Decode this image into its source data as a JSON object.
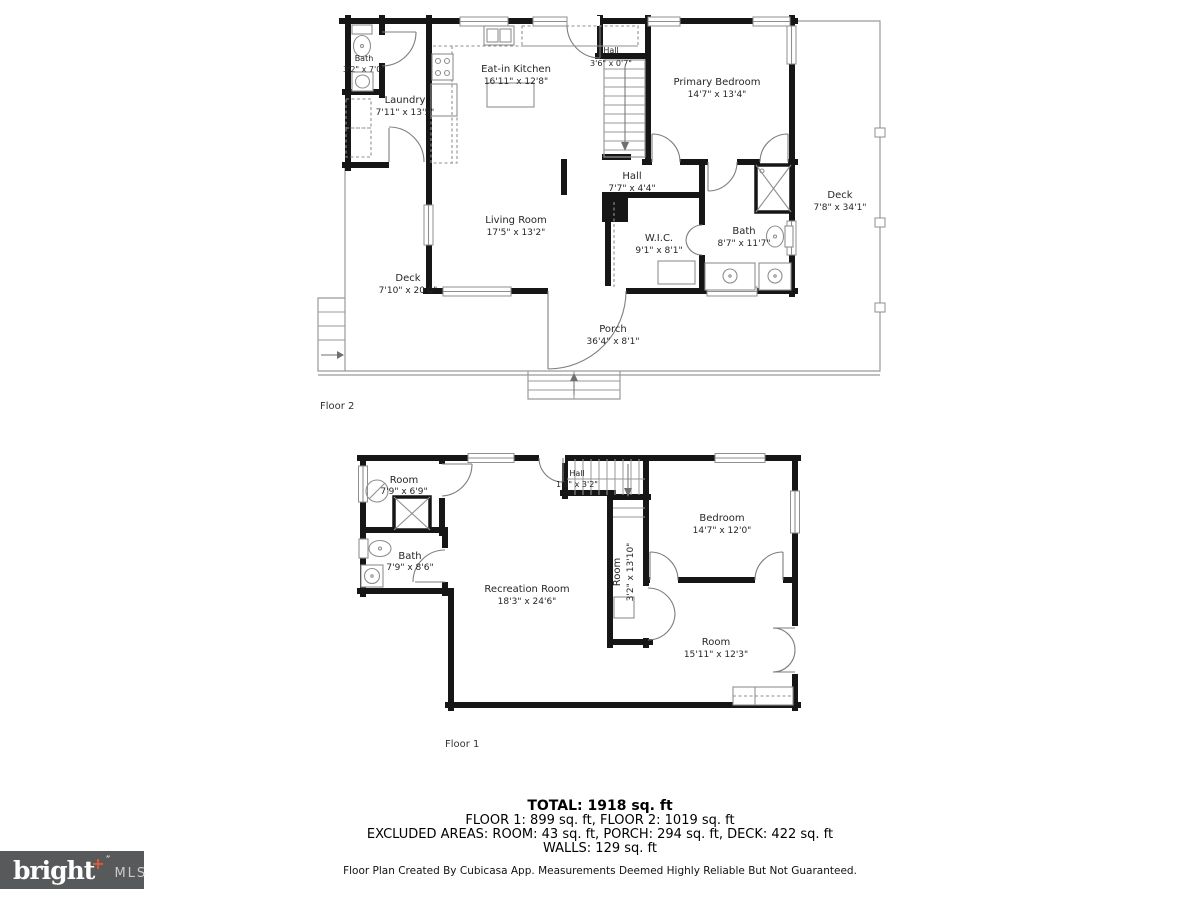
{
  "floor2": {
    "floor_label": "Floor 2",
    "rooms": {
      "bath_small": {
        "name": "Bath",
        "dims": "3'2\" x 7'0\""
      },
      "laundry": {
        "name": "Laundry",
        "dims": "7'11\" x 13'5\""
      },
      "kitchen": {
        "name": "Eat-in Kitchen",
        "dims": "16'11\" x 12'8\""
      },
      "hall_upper": {
        "name": "Hall",
        "dims": "3'6\" x 0'7\""
      },
      "primary_bedroom": {
        "name": "Primary Bedroom",
        "dims": "14'7\" x 13'4\""
      },
      "deck_right": {
        "name": "Deck",
        "dims": "7'8\" x 34'1\""
      },
      "hall": {
        "name": "Hall",
        "dims": "7'7\" x 4'4\""
      },
      "living_room": {
        "name": "Living Room",
        "dims": "17'5\" x 13'2\""
      },
      "wic": {
        "name": "W.I.C.",
        "dims": "9'1\" x 8'1\""
      },
      "bath": {
        "name": "Bath",
        "dims": "8'7\" x 11'7\""
      },
      "deck_left": {
        "name": "Deck",
        "dims": "7'10\" x 20'0\""
      },
      "porch": {
        "name": "Porch",
        "dims": "36'4\" x 8'1\""
      }
    }
  },
  "floor1": {
    "floor_label": "Floor 1",
    "rooms": {
      "room_upper": {
        "name": "Room",
        "dims": "7'9\" x 6'9\""
      },
      "bath": {
        "name": "Bath",
        "dims": "7'9\" x 8'6\""
      },
      "hall": {
        "name": "Hall",
        "dims": "1'8\" x 3'2\""
      },
      "bedroom": {
        "name": "Bedroom",
        "dims": "14'7\" x 12'0\""
      },
      "room_narrow": {
        "name": "Room",
        "dims": "3'2\" x 13'10\""
      },
      "recreation_room": {
        "name": "Recreation Room",
        "dims": "18'3\" x 24'6\""
      },
      "room_lower": {
        "name": "Room",
        "dims": "15'11\" x 12'3\""
      }
    }
  },
  "summary": {
    "total": "TOTAL: 1918 sq. ft",
    "floors": "FLOOR 1: 899 sq. ft, FLOOR 2: 1019 sq. ft",
    "excluded": "EXCLUDED AREAS: ROOM: 43 sq. ft, PORCH: 294 sq. ft, DECK: 422 sq. ft",
    "walls": "WALLS: 129 sq. ft",
    "disclaimer": "Floor Plan Created By Cubicasa App. Measurements Deemed Highly Reliable But Not Guaranteed."
  },
  "logo": {
    "brand": "bright",
    "plus": "+",
    "tm": "”",
    "suffix": "MLS"
  },
  "colors": {
    "wall": "#161616",
    "thin": "#9a9a9a",
    "accent": "#e05a33",
    "logo_bg": "#58595b"
  }
}
